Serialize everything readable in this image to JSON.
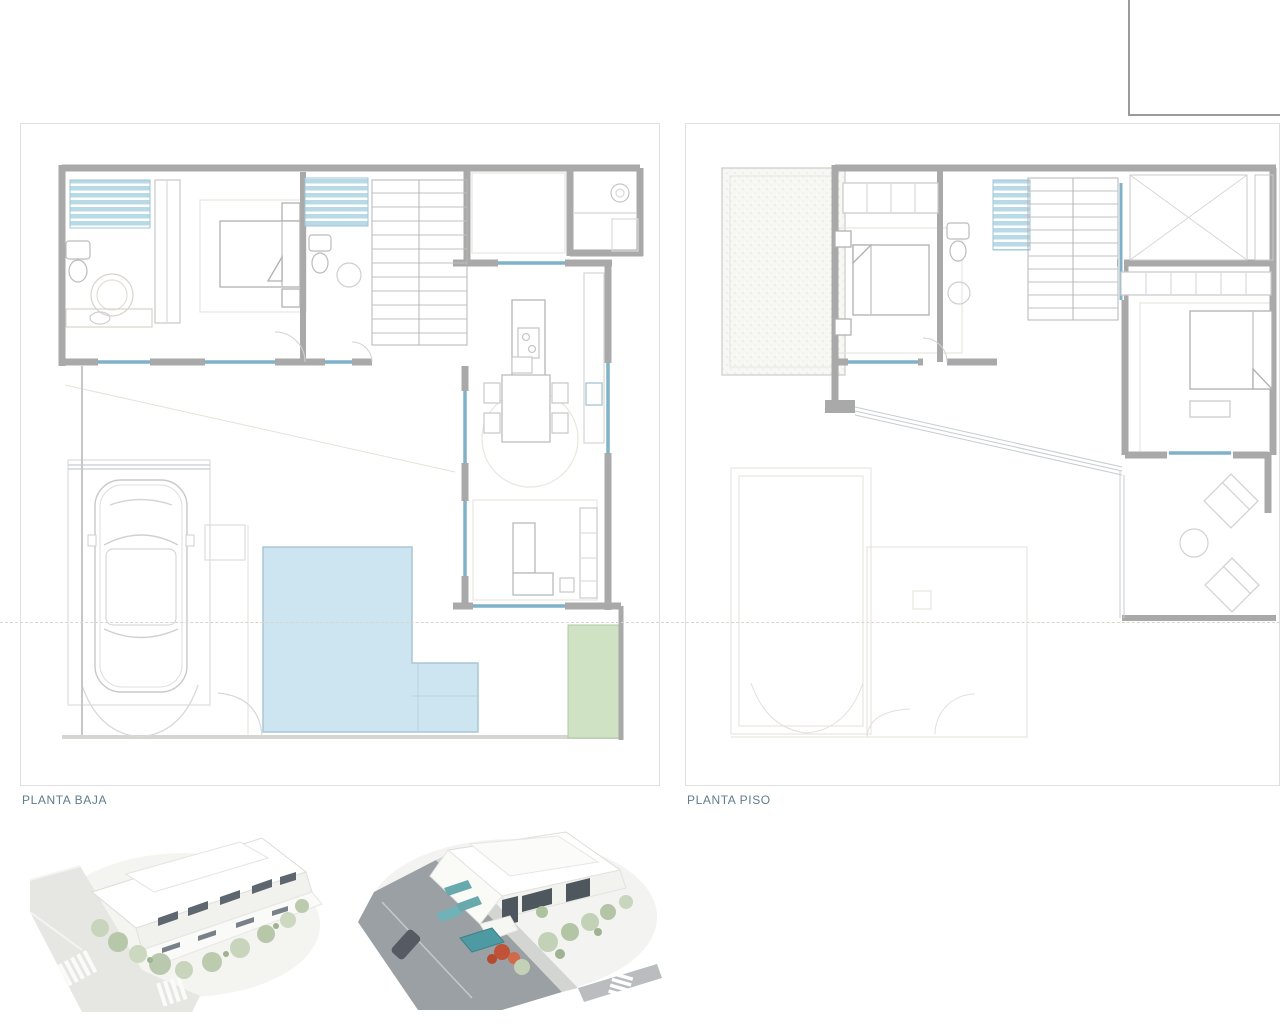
{
  "plans": {
    "left": {
      "label": "PLANTA BAJA"
    },
    "right": {
      "label": "PLANTA PISO"
    }
  },
  "colors": {
    "label_text": "#5f7d8a",
    "wall_gray": "#a9a9a9",
    "container_border": "#e0e0e0",
    "glazing_blue": "#7fb2c8",
    "shower_fill": "#b8dae6",
    "pool_fill": "#cde4f1",
    "pool_border": "#a9c6d4",
    "lawn_fill": "#cfe2c4",
    "lawn_border": "#b2c8a6",
    "setback_line_color": "#d9d4cc",
    "render_road_light": "#e6e6e3",
    "render_road_dark": "#9aa0a3",
    "render_pool_teal": "#4e9aa2",
    "render_tree_green": "#c3d2b6",
    "render_flower_red": "#c05237"
  }
}
